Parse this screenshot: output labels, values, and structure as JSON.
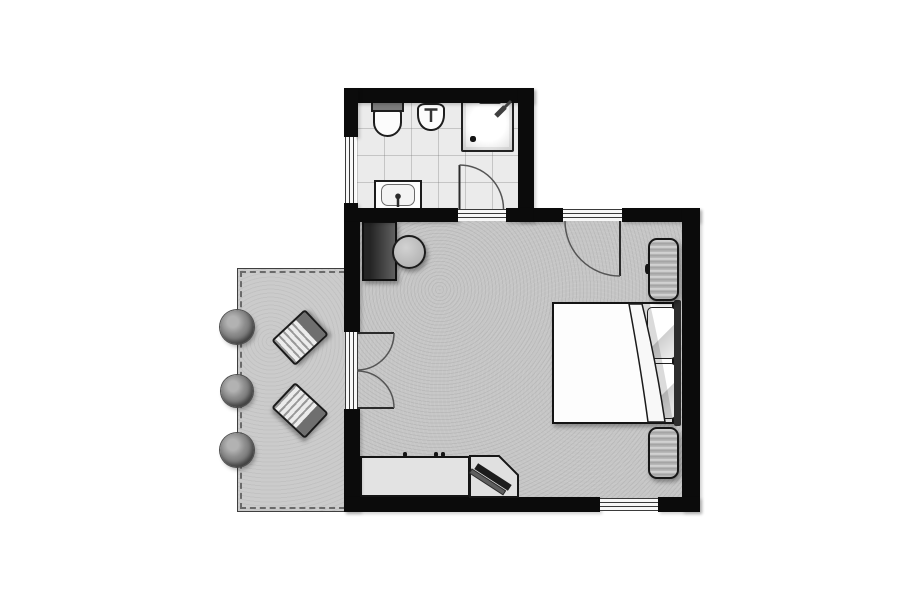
{
  "meta": {
    "title": "hotel-room-floor-plan",
    "canvas": {
      "w": 913,
      "h": 608
    }
  },
  "palette": {
    "wall": "#0b0b0b",
    "bath_floor": "#ebebeb",
    "bedroom_floor": "#c6c6c6",
    "terrace_floor": "#cbcbcb",
    "fixture_white": "#fcfcfc",
    "furniture_gray": "#b8b8b8",
    "dark_furniture": "#2d2d2d",
    "outline": "#1c1c1c"
  },
  "rooms": [
    {
      "name": "bathroom",
      "fixtures": [
        "toilet",
        "bidet",
        "shower",
        "vanity-sink",
        "window",
        "door"
      ]
    },
    {
      "name": "bedroom",
      "fixtures": [
        "double-bed",
        "pillows",
        "headboard",
        "bedside-bench-top",
        "bedside-bench-bottom",
        "wardrobe",
        "round-table",
        "counter-desk",
        "tv-corner-stand",
        "entry-door",
        "french-doors",
        "window"
      ]
    },
    {
      "name": "terrace",
      "fixtures": [
        "sun-lounger-1",
        "sun-lounger-2",
        "bush-1",
        "bush-2",
        "bush-3"
      ]
    }
  ],
  "floors": [
    {
      "name": "terrace-floor",
      "kind": "terrace",
      "x": 237,
      "y": 268,
      "w": 111,
      "h": 244
    },
    {
      "name": "bathroom-floor",
      "kind": "bath-floor",
      "x": 357,
      "y": 100,
      "w": 161,
      "h": 110
    },
    {
      "name": "bedroom-floor",
      "kind": "bedroom-floor",
      "x": 358,
      "y": 220,
      "w": 326,
      "h": 279
    }
  ],
  "furniture": [
    {
      "name": "bush-1",
      "kind": "bush",
      "x": 220,
      "y": 310,
      "w": 34,
      "h": 34
    },
    {
      "name": "bush-2",
      "kind": "bush",
      "x": 221,
      "y": 375,
      "w": 32,
      "h": 32
    },
    {
      "name": "bush-3",
      "kind": "bush",
      "x": 220,
      "y": 433,
      "w": 34,
      "h": 34
    },
    {
      "name": "sun-lounger-1",
      "kind": "lounger",
      "x": 277,
      "y": 320,
      "w": 46,
      "h": 35,
      "rot": -43
    },
    {
      "name": "sun-lounger-2",
      "kind": "lounger",
      "x": 277,
      "y": 393,
      "w": 46,
      "h": 35,
      "rot": 43
    },
    {
      "name": "toilet-tank",
      "kind": "tank",
      "x": 371,
      "y": 101,
      "w": 33,
      "h": 11
    },
    {
      "name": "toilet-bowl",
      "kind": "bowl",
      "x": 373,
      "y": 110,
      "w": 29,
      "h": 27
    },
    {
      "name": "bidet",
      "kind": "bidet",
      "x": 417,
      "y": 103,
      "w": 28,
      "h": 28
    },
    {
      "name": "shower-tray",
      "kind": "shower",
      "x": 461,
      "y": 99,
      "w": 53,
      "h": 53
    },
    {
      "name": "shower-drain",
      "kind": "knob",
      "x": 470,
      "y": 136,
      "w": 6,
      "h": 6
    },
    {
      "name": "shower-door-bar",
      "kind": "bar",
      "x": 479,
      "y": 99,
      "w": 22,
      "h": 5
    },
    {
      "name": "vanity",
      "kind": "vanity",
      "x": 374,
      "y": 180,
      "w": 48,
      "h": 31
    },
    {
      "name": "vanity-basin",
      "kind": "basin",
      "x": 381,
      "y": 184,
      "w": 34,
      "h": 22
    },
    {
      "name": "wardrobe-minibar",
      "kind": "cabinet",
      "x": 362,
      "y": 221,
      "w": 35,
      "h": 60
    },
    {
      "name": "round-table",
      "kind": "table",
      "x": 392,
      "y": 235,
      "w": 34,
      "h": 34
    },
    {
      "name": "double-bed",
      "kind": "bed",
      "x": 552,
      "y": 302,
      "w": 122,
      "h": 122
    },
    {
      "name": "pillow-top",
      "kind": "pillow",
      "x": 647,
      "y": 307,
      "w": 29,
      "h": 52
    },
    {
      "name": "pillow-bottom",
      "kind": "pillow",
      "x": 647,
      "y": 363,
      "w": 29,
      "h": 56
    },
    {
      "name": "headboard",
      "kind": "headboard",
      "x": 674,
      "y": 300,
      "w": 7,
      "h": 126
    },
    {
      "name": "bedside-bench-top",
      "kind": "bench",
      "x": 648,
      "y": 238,
      "w": 31,
      "h": 63
    },
    {
      "name": "bench-knob",
      "kind": "knob",
      "x": 645,
      "y": 264,
      "w": 5,
      "h": 10
    },
    {
      "name": "bedside-bench-bottom",
      "kind": "bench",
      "x": 648,
      "y": 427,
      "w": 31,
      "h": 52
    },
    {
      "name": "counter-desk",
      "kind": "counter",
      "x": 360,
      "y": 456,
      "w": 110,
      "h": 41
    },
    {
      "name": "counter-tick-1",
      "kind": "knob",
      "x": 403,
      "y": 452,
      "w": 4,
      "h": 5
    },
    {
      "name": "counter-tick-2",
      "kind": "knob",
      "x": 434,
      "y": 452,
      "w": 4,
      "h": 5
    },
    {
      "name": "counter-tick-3",
      "kind": "knob",
      "x": 441,
      "y": 452,
      "w": 4,
      "h": 5
    }
  ],
  "walls": [
    {
      "name": "wall-bath-top",
      "x": 344,
      "y": 88,
      "w": 190,
      "h": 15
    },
    {
      "name": "wall-bath-left-upper",
      "x": 344,
      "y": 88,
      "w": 14,
      "h": 49
    },
    {
      "name": "wall-bath-left-lower",
      "x": 344,
      "y": 203,
      "w": 14,
      "h": 19
    },
    {
      "name": "wall-bath-right",
      "x": 518,
      "y": 88,
      "w": 16,
      "h": 134
    },
    {
      "name": "wall-bath-bottom-left",
      "x": 344,
      "y": 208,
      "w": 114,
      "h": 14
    },
    {
      "name": "wall-bath-bottom-right",
      "x": 506,
      "y": 208,
      "w": 28,
      "h": 14
    },
    {
      "name": "wall-top-mid",
      "x": 534,
      "y": 208,
      "w": 29,
      "h": 14
    },
    {
      "name": "wall-top-right",
      "x": 622,
      "y": 208,
      "w": 78,
      "h": 14
    },
    {
      "name": "wall-left-upper",
      "x": 344,
      "y": 222,
      "w": 16,
      "h": 110
    },
    {
      "name": "wall-left-lower",
      "x": 344,
      "y": 409,
      "w": 16,
      "h": 103
    },
    {
      "name": "wall-right",
      "x": 682,
      "y": 208,
      "w": 18,
      "h": 304
    },
    {
      "name": "wall-bottom-left",
      "x": 344,
      "y": 497,
      "w": 256,
      "h": 15
    },
    {
      "name": "wall-bottom-right",
      "x": 658,
      "y": 497,
      "w": 42,
      "h": 15
    }
  ],
  "openings": [
    {
      "name": "bathroom-window",
      "kind": "open-v",
      "x": 345,
      "y": 137,
      "w": 11,
      "h": 66
    },
    {
      "name": "french-door-threshold",
      "kind": "open-v",
      "x": 345,
      "y": 332,
      "w": 13,
      "h": 77
    },
    {
      "name": "bathroom-door-threshold",
      "kind": "open-h",
      "x": 458,
      "y": 209,
      "w": 48,
      "h": 12
    },
    {
      "name": "entry-door-threshold",
      "kind": "open-h",
      "x": 563,
      "y": 209,
      "w": 59,
      "h": 12
    },
    {
      "name": "south-window",
      "kind": "open-h",
      "x": 600,
      "y": 498,
      "w": 58,
      "h": 13
    }
  ],
  "glyphs": [
    {
      "name": "tv-stand",
      "d": "M470,456 L499,456 L518,475 L518,497 L470,497 Z",
      "fill": "#e0e0e0",
      "stroke": "#161616",
      "width": 2
    },
    {
      "name": "tv-base",
      "d": "M472,469 L505.6,490.8 L503,494.8 L469.4,473 Z",
      "fill": "#5e5e5e",
      "stroke": "#2a2a2a",
      "width": 1
    },
    {
      "name": "tv-screen",
      "d": "M478.1,463.2 L511.7,485 L507.9,490.8 L474.3,469 Z",
      "fill": "#1c1c1c",
      "stroke": "none",
      "width": 0
    },
    {
      "name": "duvet-shadow",
      "d": "M642,304 C651,340 659,382 665,422 L673,422 C666,380 658,338 650,304 Z",
      "fill": "rgba(0,0,0,0.14)",
      "stroke": "none",
      "width": 0
    },
    {
      "name": "duvet-fold",
      "d": "M629,304 C636,342 643,384 648,422 L665,422 C659,382 651,340 642,304 Z",
      "fill": "#f8f8f8",
      "stroke": "#1b1b1b",
      "width": 1.5
    },
    {
      "name": "bathroom-door-leaf",
      "d": "M459.5,209 L459.5,165",
      "fill": "none",
      "stroke": "#2b2b2b",
      "width": 2
    },
    {
      "name": "bathroom-door-arc",
      "d": "M459.5,165 A44,44 0 0 1 503.5,209",
      "fill": "none",
      "stroke": "#555555",
      "width": 1.5
    },
    {
      "name": "entry-door-leaf",
      "d": "M620,221 L620,276",
      "fill": "none",
      "stroke": "#2b2b2b",
      "width": 2
    },
    {
      "name": "entry-door-arc",
      "d": "M565,221 A55,55 0 0 0 620,276",
      "fill": "none",
      "stroke": "#555555",
      "width": 1.5
    },
    {
      "name": "french-door-leaf-top",
      "d": "M357,333 L394,333",
      "fill": "none",
      "stroke": "#2b2b2b",
      "width": 2
    },
    {
      "name": "french-door-arc-top",
      "d": "M394,333 A37,37 0 0 1 357,370",
      "fill": "none",
      "stroke": "#555555",
      "width": 1.5
    },
    {
      "name": "french-door-leaf-bottom",
      "d": "M357,408 L394,408",
      "fill": "none",
      "stroke": "#2b2b2b",
      "width": 2
    },
    {
      "name": "french-door-arc-bottom",
      "d": "M394,408 A37,37 0 0 0 357,371",
      "fill": "none",
      "stroke": "#555555",
      "width": 1.5
    },
    {
      "name": "sink-faucet-stem",
      "d": "M398,207 L398,198",
      "fill": "none",
      "stroke": "#2b2b2b",
      "width": 2.5
    },
    {
      "name": "sink-faucet-head",
      "d": "M398,193.5 a2.8,2.8 0 1 0 0.01,0 Z",
      "fill": "#2b2b2b",
      "stroke": "none",
      "width": 0
    },
    {
      "name": "bidet-faucet",
      "d": "M431,109 L431,122 M424.5,109.5 L437.5,109.5",
      "fill": "none",
      "stroke": "#333333",
      "width": 2.5
    },
    {
      "name": "showerhead-hose",
      "d": "M511,101 L501,111",
      "fill": "none",
      "stroke": "#3f3f3f",
      "width": 3
    },
    {
      "name": "showerhead-head",
      "d": "M496,116 L505,107",
      "fill": "none",
      "stroke": "#3f3f3f",
      "width": 5
    }
  ]
}
